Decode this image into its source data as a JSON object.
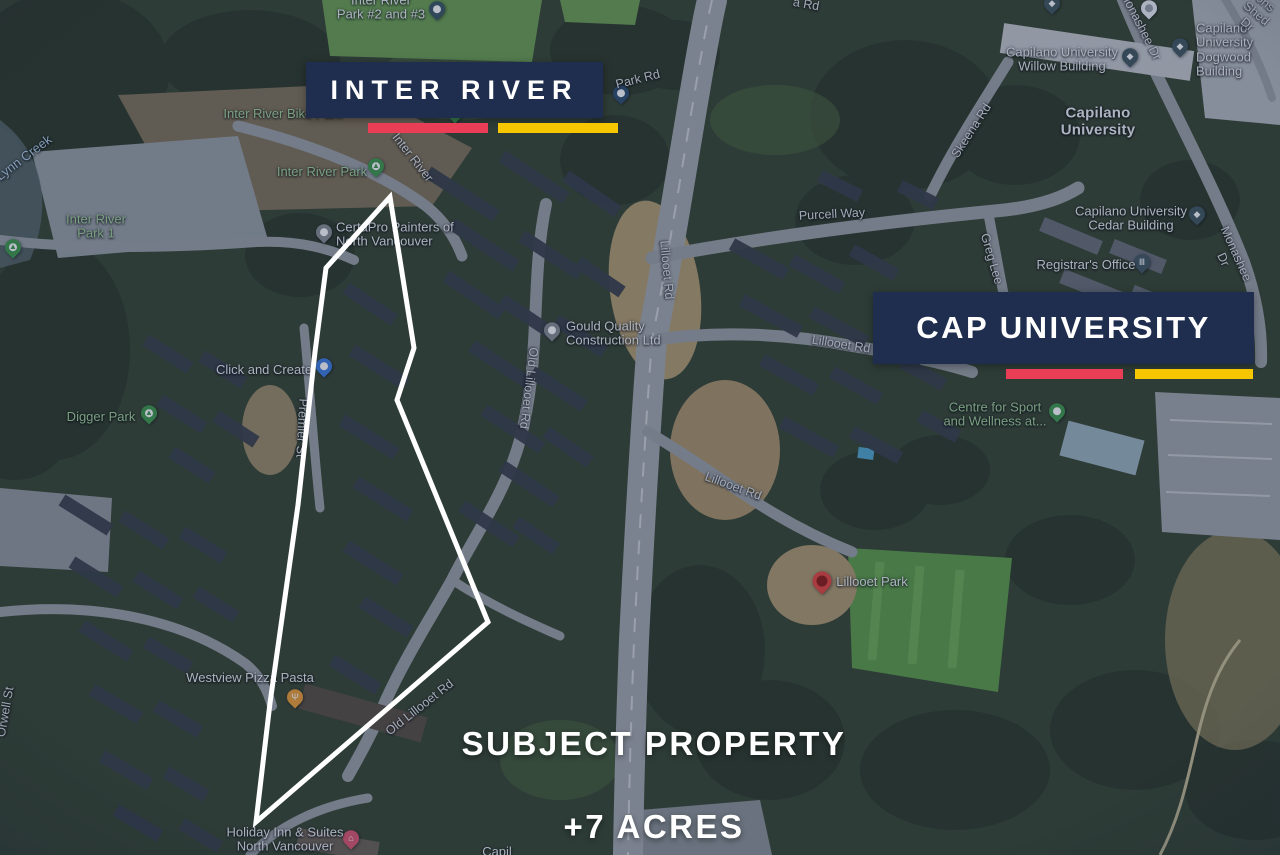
{
  "theme": {
    "callout_navy": "#1f2e4e",
    "brand_red": "#ea3d56",
    "brand_yellow": "#f6c700",
    "park_label_green": "#a6d399",
    "water_label_blue": "#b5d0e6",
    "boundary_white": "#ffffff"
  },
  "overlay": {
    "inter_river_title": "INTER RIVER",
    "cap_university_title": "CAP UNIVERSITY",
    "subject_line1": "SUBJECT PROPERTY",
    "subject_line2": "+7 ACRES"
  },
  "map": {
    "parks": {
      "bike_park": "Inter River Bike Park",
      "inter_river_park": "Inter River Park",
      "inter_river_park_1": "Inter River\nPark 1",
      "digger_park": "Digger Park",
      "sport_wellness": "Centre for Sport\nand Wellness at..."
    },
    "pois": {
      "park_2_3": "Inter River\nPark #2 and #3",
      "certapro": "CertaPro Painters of\nNorth Vancouver",
      "click_create": "Click and Create",
      "gould": "Gould Quality\nConstruction Ltd",
      "westview": "Westview Pizza Pasta",
      "holiday_inn": "Holiday Inn & Suites\nNorth Vancouver",
      "lillooet_park": "Lillooet Park",
      "registrar": "Registrar's Office",
      "willow": "Capilano University\nWillow Building",
      "dogwood": "Capilano University\nDogwood Building",
      "cedar": "Capilano University\nCedar Building",
      "capilano_university": "Capilano\nUniversity",
      "partial_bottom": "Capil"
    },
    "roads": {
      "a_rd": "a Rd",
      "park_rd": "Park Rd",
      "inter_river": "Inter River",
      "purcell_way": "Purcell Way",
      "skeena_rd": "Skeena Rd",
      "monashee_dr_top": "Monashee Dr",
      "monashee_dr_mid": "Monashee Dr",
      "greg_lee": "Greg Lee",
      "lillooet_rd_upper": "Lillooet Rd",
      "lillooet_rd_mid": "Lillooet Rd",
      "lillooet_rd_lower": "Lillooet Rd",
      "old_lillooet_upper": "Old Lillooet Rd",
      "old_lillooet_lower": "Old Lillooet Rd",
      "premier_st": "Premier St",
      "orwell_st": "Orwell St",
      "shed_dr": "ons Shed Dr"
    },
    "water": {
      "lynn_creek": "Lynn Creek"
    }
  }
}
